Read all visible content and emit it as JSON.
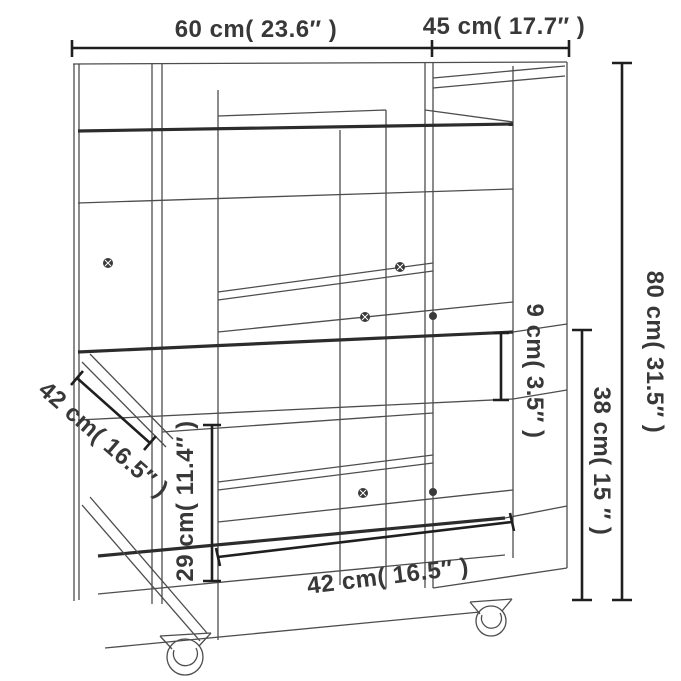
{
  "diagram": {
    "background": "#ffffff",
    "line_color": "#4d4d4d",
    "accent_line_color": "#2c2c2c",
    "dimension_line_color": "#1f1f1f",
    "label_color": "#383838",
    "dimensions": {
      "top_width": {
        "text": "60 cm( 23.6″ )",
        "cm": 60,
        "inch": 23.6
      },
      "top_depth": {
        "text": "45 cm( 17.7″ )",
        "cm": 45,
        "inch": 17.7
      },
      "height": {
        "text": "80 cm( 31.5″ )",
        "cm": 80,
        "inch": 31.5
      },
      "rim_height": {
        "text": "9 cm( 3.5″ )",
        "cm": 9,
        "inch": 3.5
      },
      "lower_clearance": {
        "text": "38 cm( 15 ″ )",
        "cm": 38,
        "inch": 15
      },
      "shelf_clearance": {
        "text": "29 cm( 11.4″ )",
        "cm": 29,
        "inch": 11.4
      },
      "shelf_depth": {
        "text": "42 cm( 16.5″ )",
        "cm": 42,
        "inch": 16.5
      },
      "shelf_width": {
        "text": "42 cm( 16.5″ )",
        "cm": 42,
        "inch": 16.5
      }
    }
  }
}
